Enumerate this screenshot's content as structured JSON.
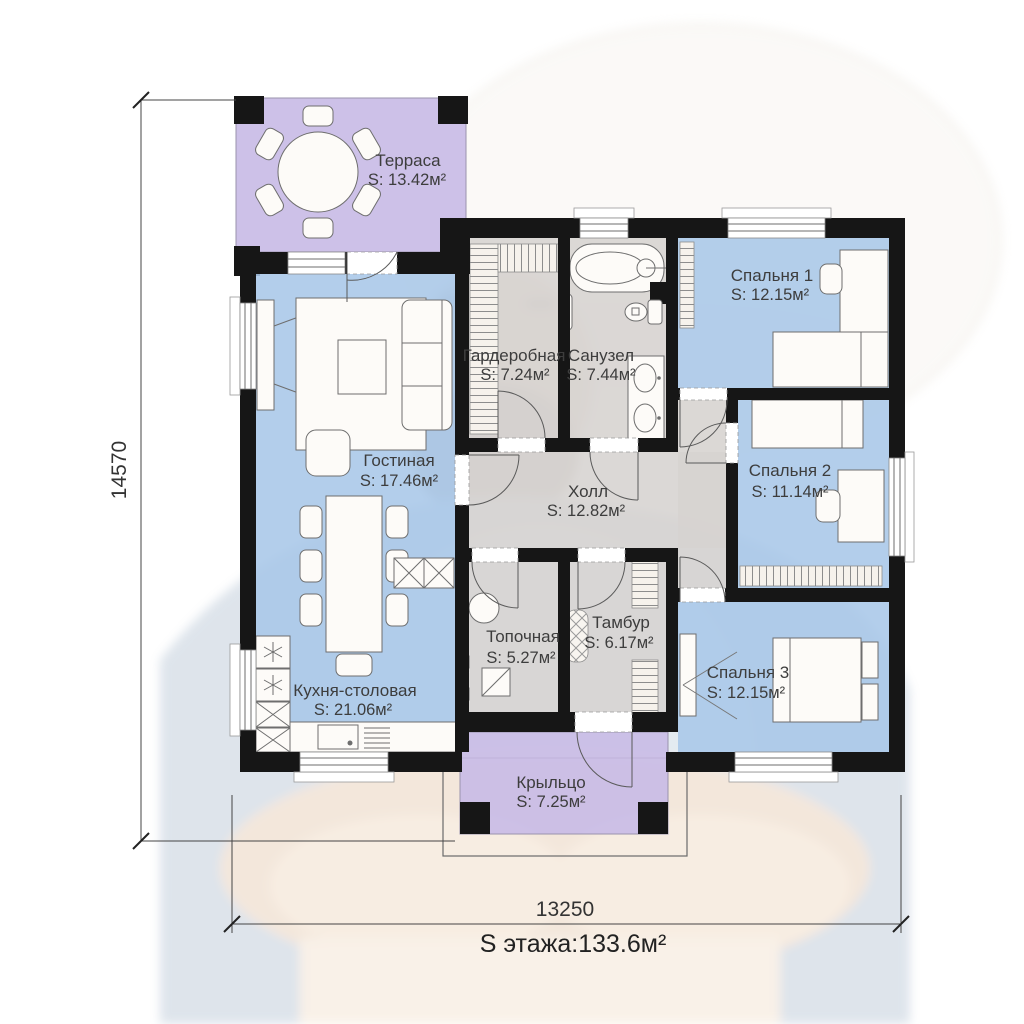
{
  "plan_title": "Floor plan",
  "dimensions": {
    "height": "14570",
    "width": "13250"
  },
  "summary": {
    "floor_area": "S  этажа:133.6м²"
  },
  "rooms": [
    {
      "id": "terrace",
      "name": "Терраса",
      "area": "S: 13.42м²"
    },
    {
      "id": "living",
      "name": "Гостиная",
      "area": "S: 17.46м²"
    },
    {
      "id": "wardrobe",
      "name": "Гардеробная",
      "area": "S: 7.24м²"
    },
    {
      "id": "bathroom",
      "name": "Санузел",
      "area": "S: 7.44м²"
    },
    {
      "id": "bedroom1",
      "name": "Спальня 1",
      "area": "S: 12.15м²"
    },
    {
      "id": "bedroom2",
      "name": "Спальня 2",
      "area": "S: 11.14м²"
    },
    {
      "id": "hall",
      "name": "Холл",
      "area": "S: 12.82м²"
    },
    {
      "id": "boiler",
      "name": "Топочная",
      "area": "S: 5.27м²"
    },
    {
      "id": "vestibule",
      "name": "Тамбур",
      "area": "S: 6.17м²"
    },
    {
      "id": "kitchen",
      "name": "Кухня-столовая",
      "area": "S: 21.06м²"
    },
    {
      "id": "bedroom3",
      "name": "Спальня 3",
      "area": "S: 12.15м²"
    },
    {
      "id": "porch",
      "name": "Крыльцо",
      "area": "S: 7.25м²"
    }
  ],
  "colors": {
    "outdoor": "#c9bce6",
    "room": "#a9c7e8",
    "zone": "#d6d3d0",
    "wall": "#161616"
  }
}
